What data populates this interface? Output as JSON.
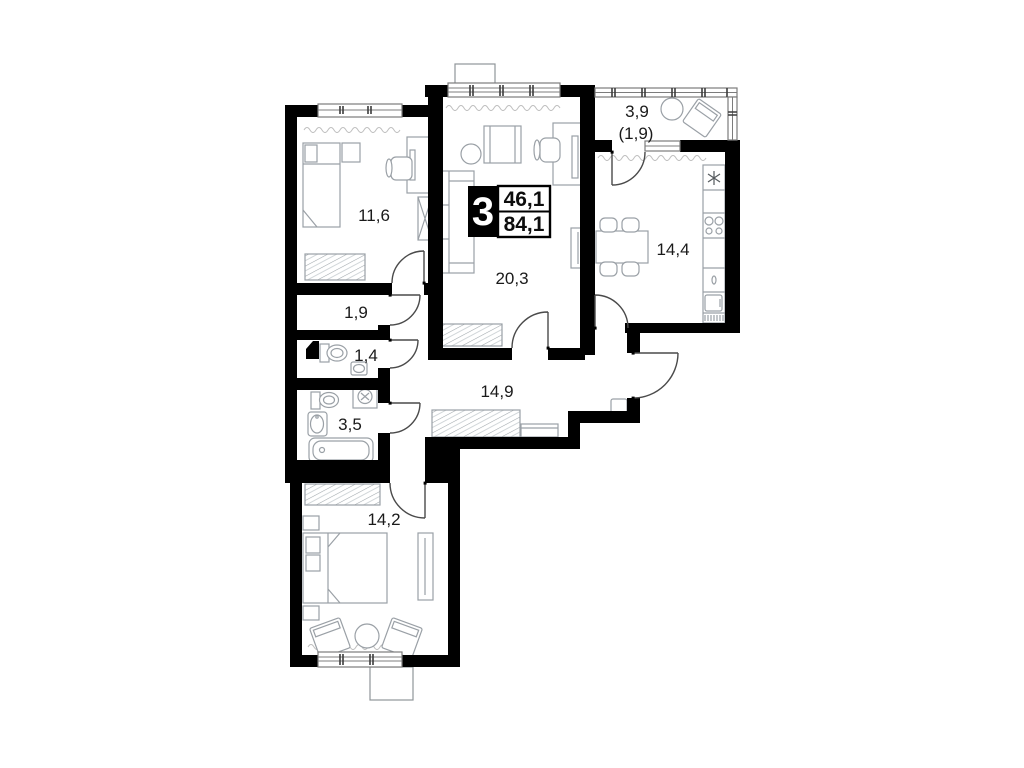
{
  "floor_plan": {
    "badge": {
      "room_count": "3",
      "living_area": "46,1",
      "total_area": "84,1"
    },
    "rooms": {
      "bedroom_top": {
        "area": "11,6"
      },
      "storage": {
        "area": "1,9"
      },
      "wc": {
        "area": "1,4"
      },
      "bathroom": {
        "area": "3,5"
      },
      "bedroom_bottom": {
        "area": "14,2"
      },
      "living_room": {
        "area": "20,3"
      },
      "hallway": {
        "area": "14,9"
      },
      "kitchen": {
        "area": "14,4"
      },
      "balcony": {
        "area": "3,9",
        "area_reduced": "(1,9)"
      }
    },
    "colors": {
      "wall": "#000000",
      "label_text": "#1a1a1a",
      "furniture_outline": "#9aa0a6",
      "badge_background": "#000000",
      "badge_text": "#ffffff"
    }
  }
}
